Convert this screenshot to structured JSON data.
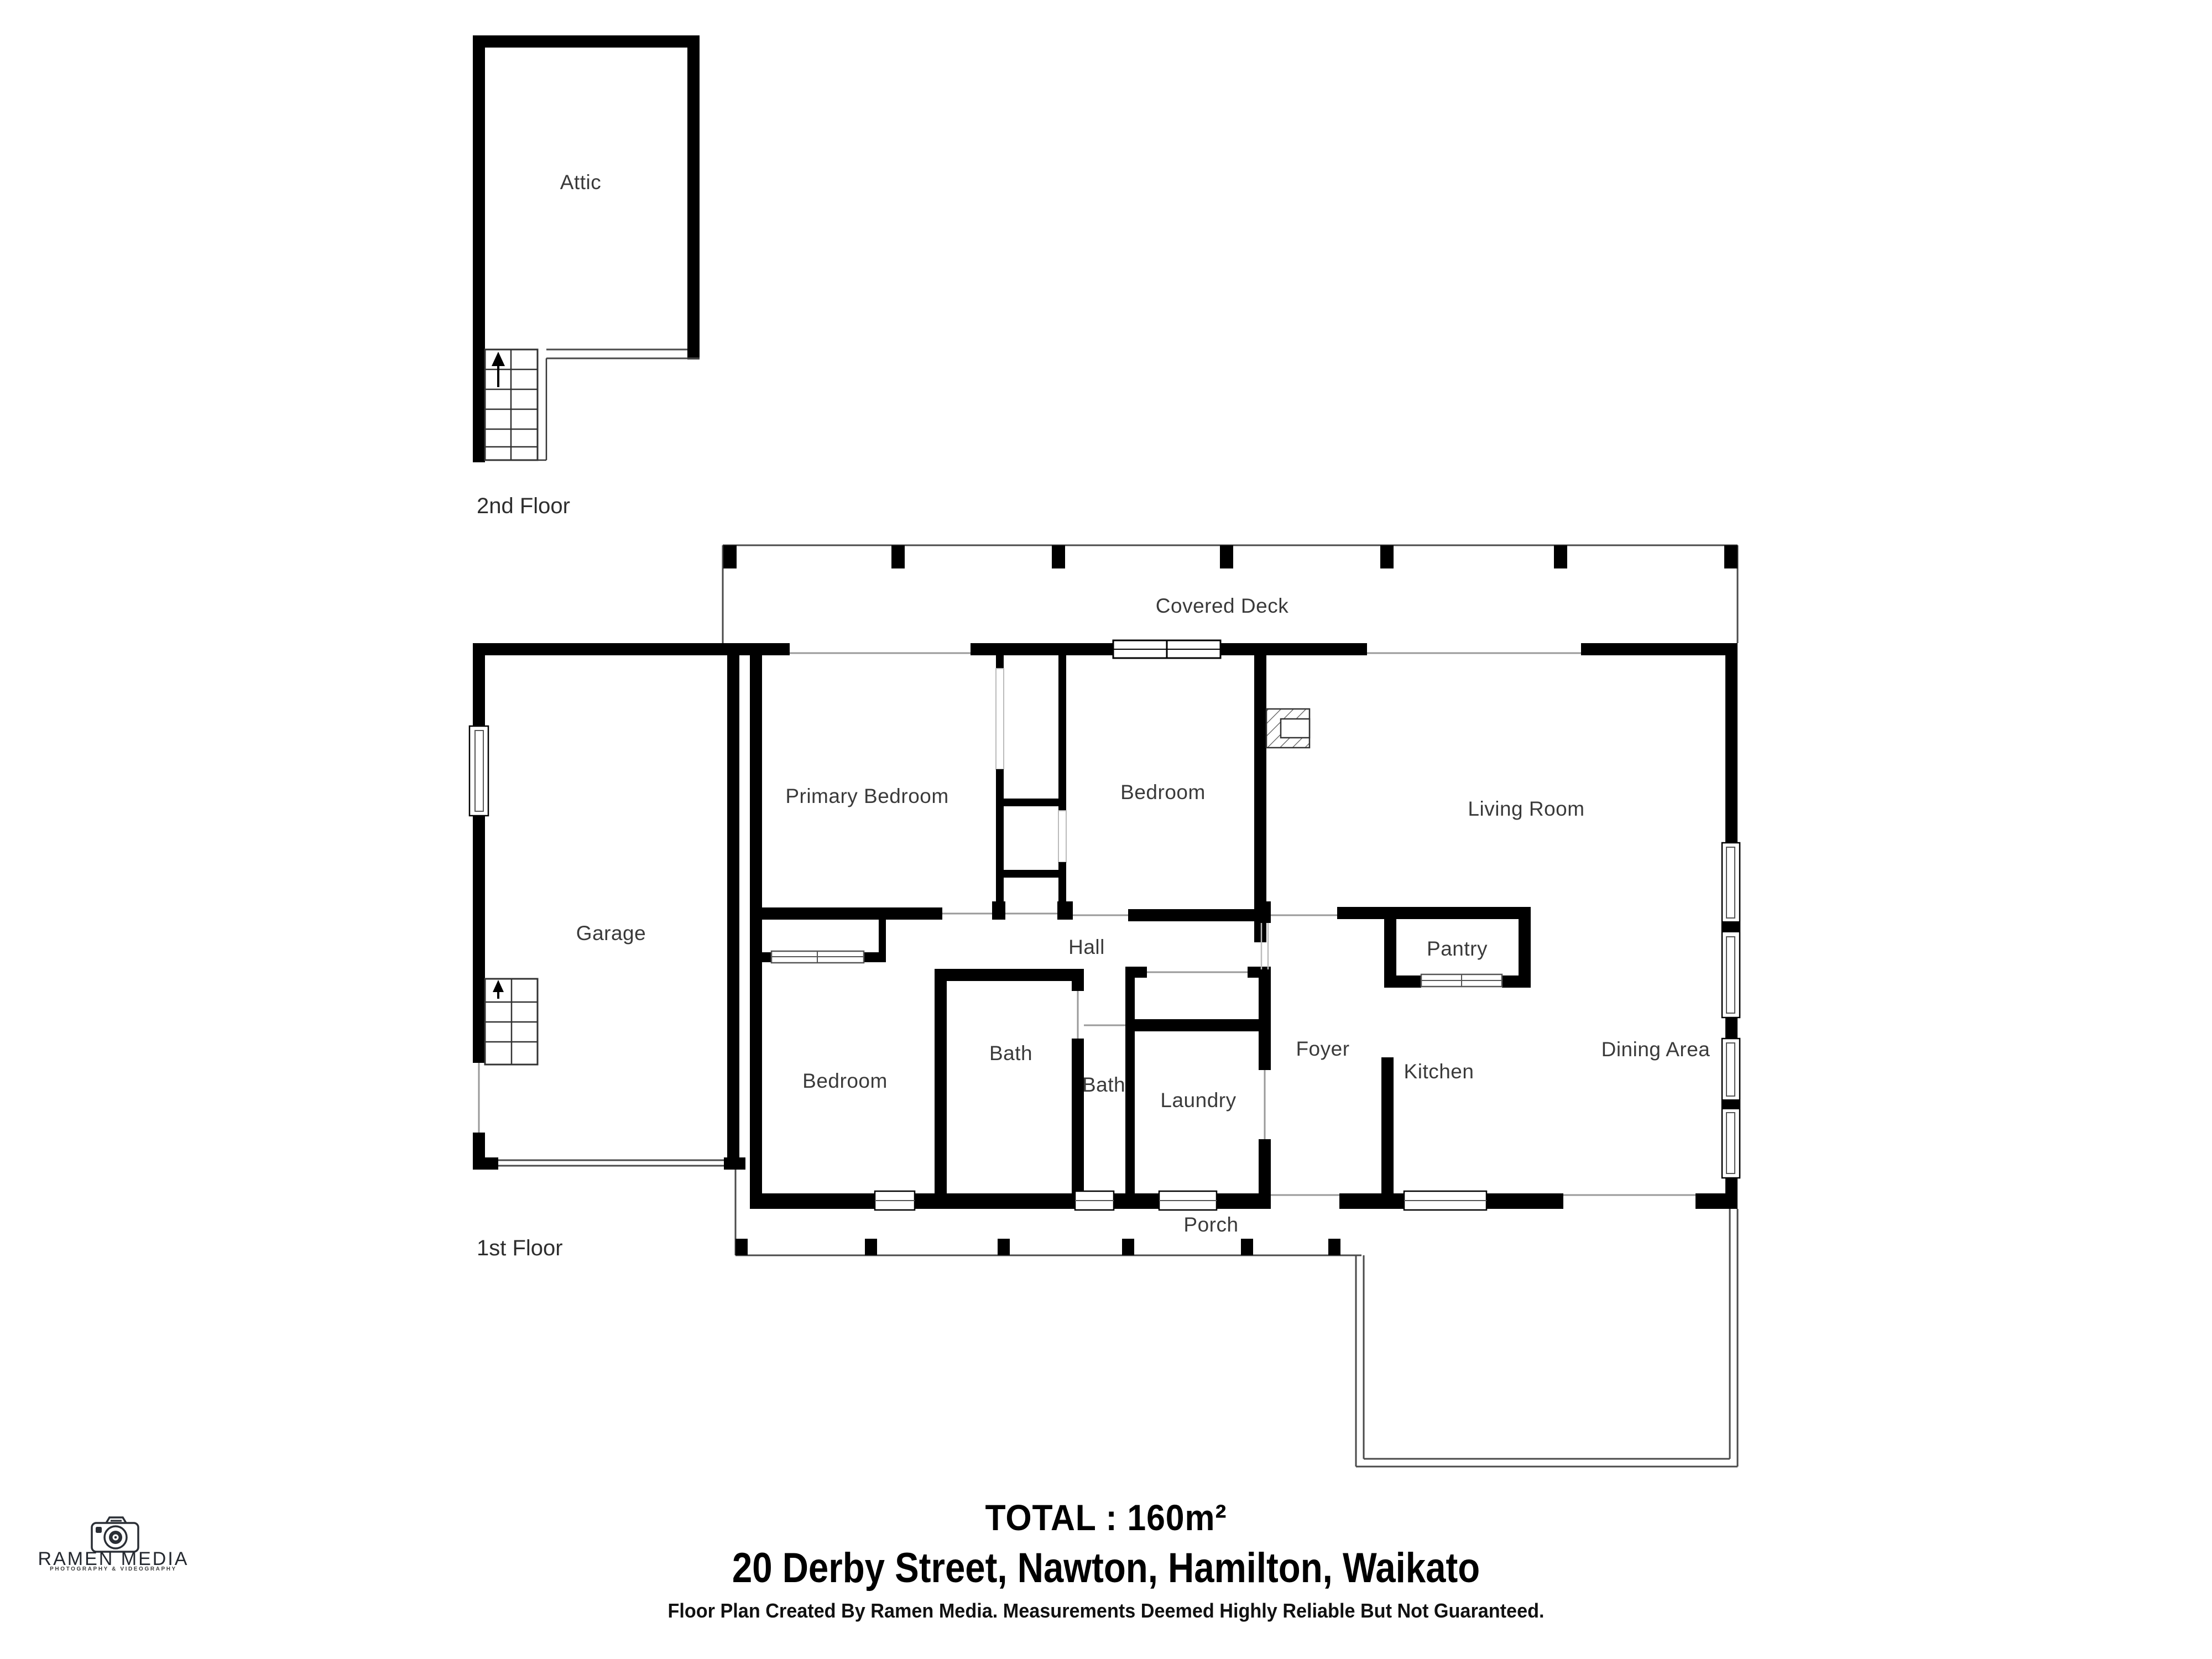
{
  "floors": {
    "second_label": "2nd Floor",
    "first_label": "1st Floor"
  },
  "rooms": {
    "attic": "Attic",
    "covered_deck": "Covered Deck",
    "primary_bedroom": "Primary Bedroom",
    "bedroom_top": "Bedroom",
    "living_room": "Living Room",
    "garage": "Garage",
    "hall": "Hall",
    "pantry": "Pantry",
    "bedroom_bottom": "Bedroom",
    "bath_main": "Bath",
    "bath_small": "Bath",
    "laundry": "Laundry",
    "foyer": "Foyer",
    "kitchen": "Kitchen",
    "dining_area": "Dining Area",
    "porch": "Porch"
  },
  "footer": {
    "total": "TOTAL : 160m²",
    "address": "20 Derby Street, Nawton, Hamilton, Waikato",
    "disclaimer": "Floor Plan Created By Ramen Media. Measurements Deemed Highly Reliable But Not Guaranteed."
  },
  "logo": {
    "name": "RAMEN MEDIA",
    "tagline": "PHOTOGRAPHY & VIDEOGRAPHY",
    "icon": "camera-icon"
  },
  "icons": {
    "stairs_direction": "up-arrow-icon"
  },
  "colors": {
    "wall": "#000000",
    "deck_line": "#4a4a4a",
    "opening_line": "#9a9a9a",
    "label_text": "#3a3a3a",
    "footer_text": "#000000",
    "logo_text": "#23272e"
  }
}
